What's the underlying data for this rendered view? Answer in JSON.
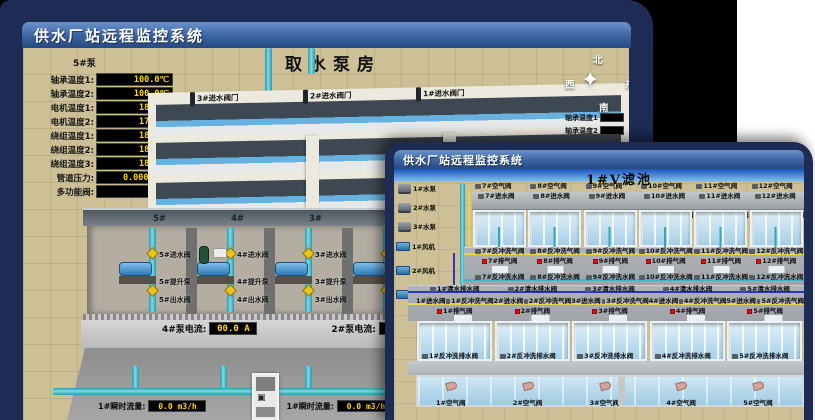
{
  "colors": {
    "frame_navy": "#1e2c55",
    "titlebar_blue": "#3c63a2",
    "value_yellow": "#ffd800",
    "alarm_red": "#e01212",
    "pipe_cyan": "#45b8cc",
    "ground_tan": "#cdc096",
    "water_blue": "#bfe0f2"
  },
  "back_window": {
    "title": "供水厂站远程监控系统",
    "scene_title": "取水泵房",
    "pump_panel": {
      "pump_label": "5#泵",
      "readings": [
        {
          "label": "轴承温度1:",
          "value": "100.0℃"
        },
        {
          "label": "轴承温度2:",
          "value": "100.0℃"
        },
        {
          "label": "电机温度1:",
          "value": "18.1℃"
        },
        {
          "label": "电机温度2:",
          "value": "17.9℃"
        },
        {
          "label": "绕组温度1:",
          "value": "18.0℃"
        },
        {
          "label": "绕组温度2:",
          "value": "18.1℃"
        },
        {
          "label": "绕组温度3:",
          "value": "18.1℃"
        },
        {
          "label": "管道压力:",
          "value": "0.0007MPa"
        },
        {
          "label": "多功能阀:",
          "value": "0%"
        }
      ]
    },
    "inlet_valves": [
      "3#进水阀门",
      "2#进水阀门",
      "1#进水阀门"
    ],
    "compass": {
      "north": "北",
      "west": "西",
      "south": "南",
      "east": "东",
      "star": "✦"
    },
    "side_readings": [
      "轴承温度1",
      "轴承温度2"
    ],
    "pump_bays": [
      {
        "bay": "5#",
        "inlet": "5#进水阀",
        "pump": "5#提升泵",
        "outlet": "5#出水阀"
      },
      {
        "bay": "4#",
        "inlet": "4#进水阀",
        "pump": "4#提升泵",
        "outlet": "4#出水阀"
      },
      {
        "bay": "3#",
        "inlet": "3#进水阀",
        "pump": "3#提升泵",
        "outlet": "3#出水阀"
      },
      {
        "bay": "2#",
        "inlet": "",
        "pump": "",
        "outlet": ""
      }
    ],
    "current_displays": [
      {
        "label": "4#泵电流:",
        "value": "00.0 A"
      },
      {
        "label": "2#泵电流:",
        "value": "00.0 A"
      }
    ],
    "flow_displays": [
      {
        "label": "1#瞬时流量:",
        "value": "0.0 m3/h"
      },
      {
        "label": "1#瞬时流量:",
        "value": "0.0 m3/h"
      }
    ]
  },
  "front_window": {
    "title": "供水厂站远程监控系统",
    "scene_title": "1#V滤池",
    "pumps": [
      "1#水泵",
      "2#水泵",
      "3#水泵"
    ],
    "blowers": [
      "1#风机",
      "2#风机",
      "3#风机"
    ],
    "top_cells": [
      {
        "air": "7#空气阀",
        "inlet": "7#进水阀",
        "drain": "7#反冲洗排水阀"
      },
      {
        "air": "8#空气阀",
        "inlet": "8#进水阀",
        "drain": "8#反冲洗排水阀"
      },
      {
        "air": "9#空气阀",
        "inlet": "9#进水阀",
        "drain": "9#反冲洗排水阀"
      },
      {
        "air": "10#空气阀",
        "inlet": "10#进水阀",
        "drain": "10#反冲洗排水阀"
      },
      {
        "air": "11#空气阀",
        "inlet": "11#进水阀",
        "drain": "11#反冲洗排水阀"
      },
      {
        "air": "12#空气阀",
        "inlet": "12#进水阀",
        "drain": "12#反冲洗排水阀"
      }
    ],
    "gallery": {
      "backwash_air_top": [
        "7#反冲洗气阀",
        "8#反冲洗气阀",
        "9#反冲洗气阀",
        "10#反冲洗气阀",
        "11#反冲洗气阀",
        "12#反冲洗气阀"
      ],
      "exhaust_top": [
        "7#排气阀",
        "8#排气阀",
        "9#排气阀",
        "10#排气阀",
        "11#排气阀",
        "12#排气阀"
      ],
      "backwash_water_top": [
        "7#反冲洗水阀",
        "8#反冲洗水阀",
        "9#反冲洗水阀",
        "10#反冲洗水阀",
        "11#反冲洗水阀",
        "12#反冲洗水阀"
      ],
      "clean_drain": [
        "1#清水排水阀",
        "2#清水排水阀",
        "3#清水排水阀",
        "4#清水排水阀",
        "5#清水排水阀"
      ],
      "bottom_manifold": [
        {
          "inlet": "1#进水阀",
          "bw_air": "1#反冲洗气阀"
        },
        {
          "inlet": "2#进水阀",
          "bw_air": "2#反冲洗气阀"
        },
        {
          "inlet": "3#进水阀",
          "bw_air": "3#反冲洗气阀"
        },
        {
          "inlet": "4#进水阀",
          "bw_air": "4#反冲洗气阀"
        },
        {
          "inlet": "5#进水阀",
          "bw_air": "5#反冲洗气阀"
        }
      ],
      "exhaust_bottom": [
        "1#排气阀",
        "2#排气阀",
        "3#排气阀",
        "4#排气阀",
        "5#排气阀"
      ]
    },
    "bottom_cells": [
      {
        "drain": "1#反冲洗排水阀",
        "inlet": "1#进水阀"
      },
      {
        "drain": "2#反冲洗排水阀",
        "inlet": "2#进水阀"
      },
      {
        "drain": "3#反冲洗排水阀",
        "inlet": "3#进水阀"
      },
      {
        "drain": "4#反冲洗排水阀",
        "inlet": "4#进水阀"
      },
      {
        "drain": "5#反冲洗排水阀",
        "inlet": "5#进水阀"
      }
    ],
    "trough_air": [
      "1#空气阀",
      "2#空气阀",
      "3#空气阀",
      "4#空气阀",
      "5#空气阀"
    ]
  }
}
